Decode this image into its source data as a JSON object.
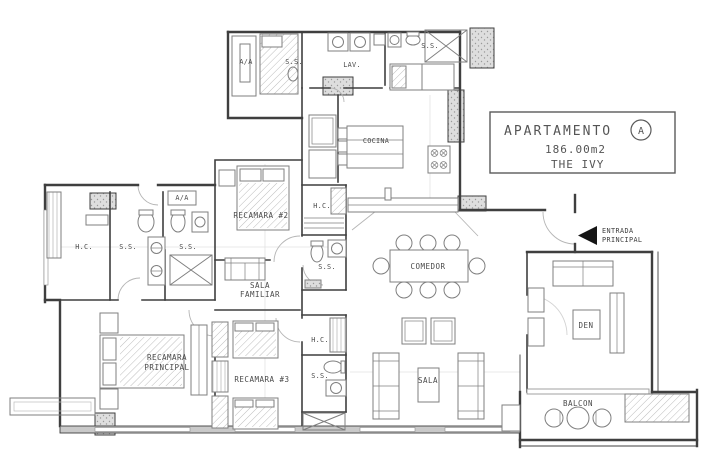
{
  "title_block": {
    "line1": "APARTAMENTO",
    "unit": "A",
    "area": "186.00m2",
    "building": "THE IVY"
  },
  "entrance": {
    "line1": "ENTRADA",
    "line2": "PRINCIPAL"
  },
  "rooms": {
    "recamara2": "RECAMARA #2",
    "sala_familiar_line1": "SALA",
    "sala_familiar_line2": "FAMILIAR",
    "recamara_principal_line1": "RECAMARA",
    "recamara_principal_line2": "PRINCIPAL",
    "recamara3": "RECAMARA #3",
    "comedor": "COMEDOR",
    "sala": "SALA",
    "den": "DEN",
    "balcon": "BALCON",
    "cocina": "COCINA",
    "lavanderia": "LAV."
  },
  "utility_labels": {
    "aa_service": "A/A",
    "ss_service": "S.S.",
    "ss_maid": "S.S.",
    "aa_hall": "A/A",
    "hc_master": "H.C.",
    "ss_master_1": "S.S.",
    "ss_master_2": "S.S.",
    "hc_recamara2": "H.C.",
    "ss_guest": "S.S.",
    "hc_recamara3": "H.C.",
    "ss_recamara3": "S.S."
  },
  "colors": {
    "wall_ink": "#3f3f3f",
    "furniture_ink": "#808080",
    "label_ink": "#4a4a4a",
    "entrance_arrow": "#111111",
    "paper": "#ffffff"
  }
}
